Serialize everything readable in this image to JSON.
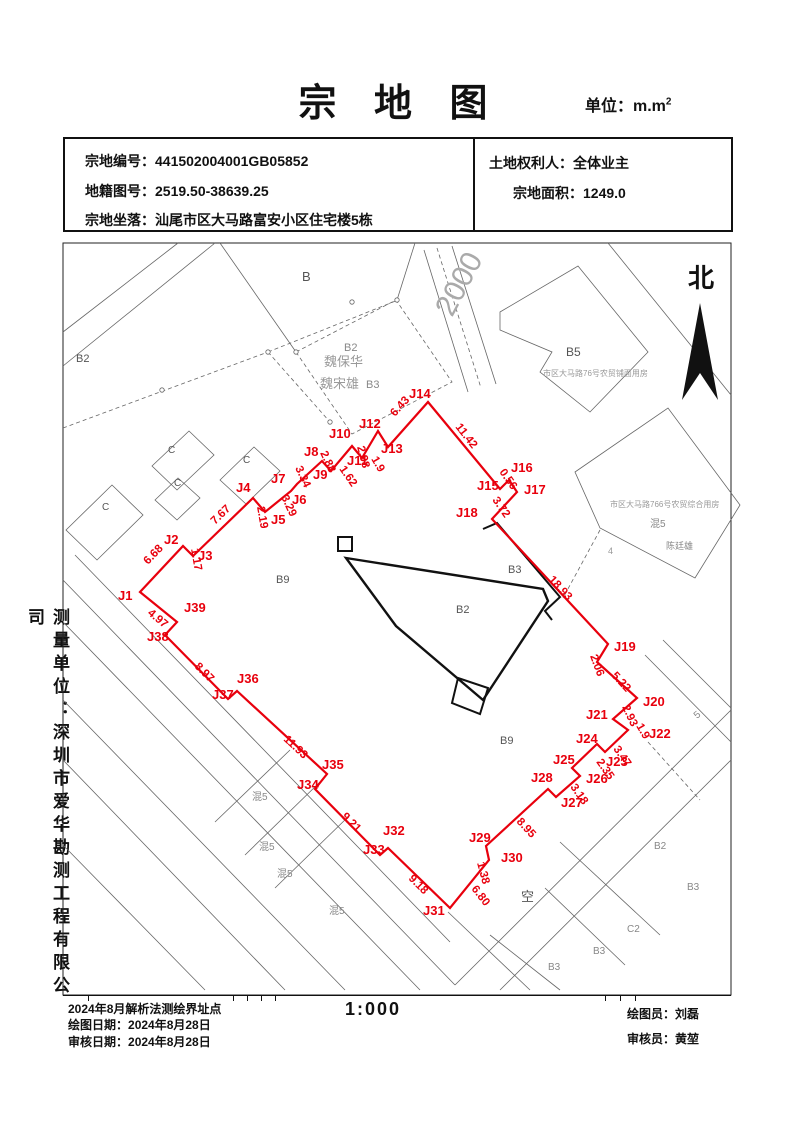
{
  "title": {
    "text": "宗 地 图",
    "unit_prefix": "单位：m.m",
    "unit_sup": "2"
  },
  "info_box": {
    "rows": [
      {
        "label": "宗地编号：",
        "value": "441502004001GB05852"
      },
      {
        "label": "地籍图号：",
        "value": "2519.50-38639.25"
      },
      {
        "label": "宗地坐落：",
        "value": "汕尾市区大马路富安小区住宅楼5栋"
      }
    ],
    "owner_label": "土地权利人：",
    "owner": "全体业主",
    "area_label": "宗地面积：",
    "area": "1249.0"
  },
  "north_label": "北",
  "sidebar_text": "测量单位：深圳市爱华勘测工程有限公司",
  "footer": {
    "method": "2024年8月解析法测绘界址点",
    "draw_label": "绘图日期：",
    "draw_date": "2024年8月28日",
    "check_label": "审核日期：",
    "check_date": "2024年8月28日",
    "scale": "1:000",
    "drafter_label": "绘图员：",
    "drafter": "刘磊",
    "checker_label": "审核员：",
    "checker": "黄堃"
  },
  "map": {
    "accent_color": "#e8000d",
    "parcel": {
      "points": [
        {
          "n": "J1",
          "x": 140,
          "y": 592
        },
        {
          "n": "J2",
          "x": 183,
          "y": 546
        },
        {
          "n": "J3",
          "x": 193,
          "y": 556
        },
        {
          "n": "J4",
          "x": 253,
          "y": 498
        },
        {
          "n": "J5",
          "x": 265,
          "y": 512
        },
        {
          "n": "J6",
          "x": 291,
          "y": 491
        },
        {
          "n": "J7",
          "x": 297,
          "y": 484
        },
        {
          "n": "J8",
          "x": 322,
          "y": 461
        },
        {
          "n": "J9",
          "x": 331,
          "y": 471
        },
        {
          "n": "J10",
          "x": 352,
          "y": 446
        },
        {
          "n": "J11",
          "x": 362,
          "y": 458
        },
        {
          "n": "J12",
          "x": 378,
          "y": 431
        },
        {
          "n": "J13",
          "x": 388,
          "y": 447
        },
        {
          "n": "J14",
          "x": 428,
          "y": 402
        },
        {
          "n": "J15",
          "x": 500,
          "y": 489
        },
        {
          "n": "J16",
          "x": 509,
          "y": 480
        },
        {
          "n": "J17",
          "x": 517,
          "y": 492
        },
        {
          "n": "J18",
          "x": 492,
          "y": 519
        },
        {
          "n": "J19",
          "x": 608,
          "y": 644
        },
        {
          "n": "",
          "x": 597,
          "y": 662
        },
        {
          "n": "J20",
          "x": 637,
          "y": 698
        },
        {
          "n": "J21",
          "x": 613,
          "y": 719
        },
        {
          "n": "J22",
          "x": 628,
          "y": 730
        },
        {
          "n": "J23",
          "x": 605,
          "y": 752
        },
        {
          "n": "J24",
          "x": 597,
          "y": 744
        },
        {
          "n": "J25",
          "x": 572,
          "y": 768
        },
        {
          "n": "J26",
          "x": 580,
          "y": 776
        },
        {
          "n": "J27",
          "x": 556,
          "y": 797
        },
        {
          "n": "J28",
          "x": 548,
          "y": 789
        },
        {
          "n": "J29",
          "x": 486,
          "y": 846
        },
        {
          "n": "J30",
          "x": 489,
          "y": 860
        },
        {
          "n": "J31",
          "x": 450,
          "y": 908
        },
        {
          "n": "J32",
          "x": 388,
          "y": 848
        },
        {
          "n": "J33",
          "x": 380,
          "y": 855
        },
        {
          "n": "J34",
          "x": 315,
          "y": 789
        },
        {
          "n": "J35",
          "x": 327,
          "y": 774
        },
        {
          "n": "J36",
          "x": 237,
          "y": 691
        },
        {
          "n": "J37",
          "x": 228,
          "y": 699
        },
        {
          "n": "J38",
          "x": 165,
          "y": 635
        },
        {
          "n": "J39",
          "x": 177,
          "y": 622
        }
      ]
    },
    "point_labels": [
      {
        "t": "J1",
        "x": 118,
        "y": 600
      },
      {
        "t": "J2",
        "x": 164,
        "y": 544
      },
      {
        "t": "J3",
        "x": 198,
        "y": 560
      },
      {
        "t": "J4",
        "x": 236,
        "y": 492
      },
      {
        "t": "J5",
        "x": 271,
        "y": 524
      },
      {
        "t": "J6",
        "x": 292,
        "y": 504
      },
      {
        "t": "J7",
        "x": 271,
        "y": 483
      },
      {
        "t": "J8",
        "x": 304,
        "y": 456
      },
      {
        "t": "J9",
        "x": 313,
        "y": 479
      },
      {
        "t": "J10",
        "x": 329,
        "y": 438
      },
      {
        "t": "J11",
        "x": 347,
        "y": 465
      },
      {
        "t": "J12",
        "x": 359,
        "y": 428
      },
      {
        "t": "J13",
        "x": 381,
        "y": 453
      },
      {
        "t": "J14",
        "x": 409,
        "y": 398
      },
      {
        "t": "J15",
        "x": 477,
        "y": 490
      },
      {
        "t": "J16",
        "x": 511,
        "y": 472
      },
      {
        "t": "J17",
        "x": 524,
        "y": 494
      },
      {
        "t": "J18",
        "x": 456,
        "y": 517
      },
      {
        "t": "J19",
        "x": 614,
        "y": 651
      },
      {
        "t": "J20",
        "x": 643,
        "y": 706
      },
      {
        "t": "J21",
        "x": 586,
        "y": 719
      },
      {
        "t": "J22",
        "x": 649,
        "y": 738
      },
      {
        "t": "J23",
        "x": 606,
        "y": 766
      },
      {
        "t": "J24",
        "x": 576,
        "y": 743
      },
      {
        "t": "J25",
        "x": 553,
        "y": 764
      },
      {
        "t": "J26",
        "x": 586,
        "y": 783
      },
      {
        "t": "J27",
        "x": 561,
        "y": 807
      },
      {
        "t": "J28",
        "x": 531,
        "y": 782
      },
      {
        "t": "J29",
        "x": 469,
        "y": 842
      },
      {
        "t": "J30",
        "x": 501,
        "y": 862
      },
      {
        "t": "J31",
        "x": 423,
        "y": 915
      },
      {
        "t": "J32",
        "x": 383,
        "y": 835
      },
      {
        "t": "J33",
        "x": 363,
        "y": 854
      },
      {
        "t": "J34",
        "x": 297,
        "y": 789
      },
      {
        "t": "J35",
        "x": 322,
        "y": 769
      },
      {
        "t": "J36",
        "x": 237,
        "y": 683
      },
      {
        "t": "J37",
        "x": 212,
        "y": 699
      },
      {
        "t": "J38",
        "x": 147,
        "y": 641
      },
      {
        "t": "J39",
        "x": 184,
        "y": 612
      }
    ],
    "distance_labels": [
      {
        "t": "6.68",
        "x": 148,
        "y": 565,
        "r": -46
      },
      {
        "t": "1.17",
        "x": 191,
        "y": 549,
        "r": 80
      },
      {
        "t": "7.67",
        "x": 215,
        "y": 525,
        "r": -44
      },
      {
        "t": "2.19",
        "x": 257,
        "y": 507,
        "r": 80
      },
      {
        "t": "3.29",
        "x": 281,
        "y": 497,
        "r": 65
      },
      {
        "t": "3.34",
        "x": 295,
        "y": 468,
        "r": 65
      },
      {
        "t": "2.88",
        "x": 320,
        "y": 453,
        "r": 65
      },
      {
        "t": "2.98",
        "x": 357,
        "y": 447,
        "r": 75
      },
      {
        "t": "1.62",
        "x": 339,
        "y": 469,
        "r": 55
      },
      {
        "t": "1.9",
        "x": 371,
        "y": 459,
        "r": 60
      },
      {
        "t": "6.43",
        "x": 395,
        "y": 417,
        "r": -48
      },
      {
        "t": "11.42",
        "x": 455,
        "y": 427,
        "r": 52
      },
      {
        "t": "0.56",
        "x": 499,
        "y": 472,
        "r": 55
      },
      {
        "t": "3.72",
        "x": 492,
        "y": 500,
        "r": 55
      },
      {
        "t": "18.93",
        "x": 548,
        "y": 580,
        "r": 47
      },
      {
        "t": "2.06",
        "x": 590,
        "y": 656,
        "r": 70
      },
      {
        "t": "5.22",
        "x": 611,
        "y": 676,
        "r": 47
      },
      {
        "t": "2.93",
        "x": 622,
        "y": 707,
        "r": 65
      },
      {
        "t": "1.9",
        "x": 636,
        "y": 726,
        "r": 60
      },
      {
        "t": "3.47",
        "x": 613,
        "y": 749,
        "r": 55
      },
      {
        "t": "2.35",
        "x": 596,
        "y": 762,
        "r": 55
      },
      {
        "t": "3.18",
        "x": 570,
        "y": 787,
        "r": 55
      },
      {
        "t": "8.95",
        "x": 516,
        "y": 822,
        "r": 47
      },
      {
        "t": "1.38",
        "x": 477,
        "y": 863,
        "r": 75
      },
      {
        "t": "6.80",
        "x": 471,
        "y": 889,
        "r": 52
      },
      {
        "t": "9.18",
        "x": 408,
        "y": 879,
        "r": 45
      },
      {
        "t": "9.21",
        "x": 341,
        "y": 817,
        "r": 45
      },
      {
        "t": "11.93",
        "x": 283,
        "y": 740,
        "r": 43
      },
      {
        "t": "8.97",
        "x": 194,
        "y": 667,
        "r": 45
      },
      {
        "t": "4.97",
        "x": 147,
        "y": 614,
        "r": 40
      }
    ],
    "bg_labels": [
      {
        "t": "B2",
        "x": 76,
        "y": 362,
        "s": 11,
        "c": "#555",
        "r": 0
      },
      {
        "t": "B",
        "x": 302,
        "y": 281,
        "s": 13,
        "c": "#555",
        "r": 0
      },
      {
        "t": "C",
        "x": 168,
        "y": 453,
        "s": 10,
        "c": "#555",
        "r": 0
      },
      {
        "t": "C",
        "x": 174,
        "y": 486,
        "s": 10,
        "c": "#555",
        "r": 0
      },
      {
        "t": "C",
        "x": 243,
        "y": 463,
        "s": 10,
        "c": "#555",
        "r": 0
      },
      {
        "t": "C",
        "x": 102,
        "y": 510,
        "s": 10,
        "c": "#555",
        "r": 0
      },
      {
        "t": "B2",
        "x": 344,
        "y": 351,
        "s": 11,
        "c": "#888",
        "r": 0
      },
      {
        "t": "魏保华",
        "x": 324,
        "y": 366,
        "s": 13,
        "c": "#999",
        "r": 0
      },
      {
        "t": "魏宋雄",
        "x": 320,
        "y": 388,
        "s": 13,
        "c": "#999",
        "r": 0
      },
      {
        "t": "B3",
        "x": 366,
        "y": 388,
        "s": 11,
        "c": "#888",
        "r": 0
      },
      {
        "t": "2000",
        "x": 452,
        "y": 318,
        "s": 30,
        "c": "#aaa",
        "r": -62
      },
      {
        "t": "B5",
        "x": 566,
        "y": 356,
        "s": 12,
        "c": "#555",
        "r": 0
      },
      {
        "t": "市区大马路76号农贸铺面用房",
        "x": 543,
        "y": 376,
        "s": 8,
        "c": "#999",
        "r": 0
      },
      {
        "t": "市区大马路766号农贸综合用房",
        "x": 610,
        "y": 507,
        "s": 8,
        "c": "#999",
        "r": 0
      },
      {
        "t": "混5",
        "x": 650,
        "y": 527,
        "s": 10,
        "c": "#888",
        "r": 0
      },
      {
        "t": "陈廷雄",
        "x": 666,
        "y": 549,
        "s": 9,
        "c": "#888",
        "r": 0
      },
      {
        "t": "B9",
        "x": 276,
        "y": 583,
        "s": 11,
        "c": "#555",
        "r": 0
      },
      {
        "t": "B3",
        "x": 508,
        "y": 573,
        "s": 11,
        "c": "#555",
        "r": 0
      },
      {
        "t": "B2",
        "x": 456,
        "y": 613,
        "s": 11,
        "c": "#555",
        "r": 0
      },
      {
        "t": "B9",
        "x": 500,
        "y": 744,
        "s": 11,
        "c": "#555",
        "r": 0
      },
      {
        "t": "混5",
        "x": 252,
        "y": 800,
        "s": 10,
        "c": "#888",
        "r": 0
      },
      {
        "t": "混5",
        "x": 259,
        "y": 850,
        "s": 10,
        "c": "#888",
        "r": 0
      },
      {
        "t": "混5",
        "x": 277,
        "y": 877,
        "s": 10,
        "c": "#888",
        "r": 0
      },
      {
        "t": "混5",
        "x": 329,
        "y": 914,
        "s": 10,
        "c": "#888",
        "r": 0
      },
      {
        "t": "空",
        "x": 521,
        "y": 901,
        "s": 13,
        "c": "#555",
        "r": 0
      },
      {
        "t": "B2",
        "x": 654,
        "y": 849,
        "s": 10,
        "c": "#888",
        "r": 0
      },
      {
        "t": "B3",
        "x": 687,
        "y": 890,
        "s": 10,
        "c": "#888",
        "r": 0
      },
      {
        "t": "C2",
        "x": 627,
        "y": 932,
        "s": 10,
        "c": "#888",
        "r": 0
      },
      {
        "t": "B3",
        "x": 593,
        "y": 954,
        "s": 10,
        "c": "#888",
        "r": 0
      },
      {
        "t": "B3",
        "x": 548,
        "y": 970,
        "s": 10,
        "c": "#888",
        "r": 0
      },
      {
        "t": "5",
        "x": 697,
        "y": 719,
        "s": 10,
        "c": "#888",
        "r": -40
      },
      {
        "t": "4",
        "x": 608,
        "y": 554,
        "s": 9,
        "c": "#999",
        "r": 0
      }
    ],
    "bg_lines": [
      [
        63,
        332,
        178,
        243,
        0
      ],
      [
        63,
        366,
        215,
        243,
        0
      ],
      [
        75,
        555,
        450,
        942,
        0
      ],
      [
        63,
        580,
        455,
        985,
        0
      ],
      [
        63,
        622,
        420,
        990,
        0
      ],
      [
        63,
        700,
        345,
        990,
        0
      ],
      [
        63,
        760,
        285,
        990,
        0
      ],
      [
        63,
        845,
        205,
        990,
        0
      ],
      [
        215,
        822,
        290,
        750,
        0
      ],
      [
        245,
        855,
        320,
        782,
        0
      ],
      [
        275,
        888,
        350,
        815,
        0
      ],
      [
        455,
        985,
        731,
        710,
        0
      ],
      [
        500,
        990,
        731,
        760,
        0
      ],
      [
        560,
        842,
        660,
        935,
        0
      ],
      [
        545,
        888,
        625,
        965,
        0
      ],
      [
        490,
        935,
        560,
        990,
        0
      ],
      [
        448,
        912,
        530,
        990,
        0
      ],
      [
        645,
        655,
        731,
        742,
        0
      ],
      [
        663,
        640,
        731,
        708,
        0
      ],
      [
        608,
        243,
        731,
        395,
        0
      ],
      [
        424,
        250,
        468,
        392,
        0
      ],
      [
        452,
        246,
        496,
        384,
        0
      ],
      [
        437,
        248,
        481,
        388,
        1
      ],
      [
        63,
        428,
        268,
        352,
        1
      ],
      [
        268,
        352,
        398,
        300,
        1
      ],
      [
        268,
        352,
        330,
        422,
        1
      ],
      [
        220,
        243,
        296,
        352,
        0
      ],
      [
        397,
        300,
        415,
        243,
        0
      ],
      [
        600,
        530,
        563,
        598,
        1
      ],
      [
        648,
        742,
        700,
        800,
        1
      ]
    ],
    "bg_polys": [
      {
        "pts": "152,466 189,431 214,455 177,490",
        "dash": 0
      },
      {
        "pts": "155,500 178,478 200,498 177,520",
        "dash": 0
      },
      {
        "pts": "220,480 254,447 280,471 246,504",
        "dash": 0
      },
      {
        "pts": "66,530 112,485 143,515 97,560",
        "dash": 0
      },
      {
        "pts": "296,352 396,300 452,382 352,434",
        "dash": 1
      },
      {
        "pts": "500,312 578,266 648,352 590,412 540,372 552,352 500,330",
        "dash": 0
      },
      {
        "pts": "575,472 668,408 740,505 695,578 600,528",
        "dash": 0
      }
    ],
    "node_circles": [
      [
        162,
        390
      ],
      [
        268,
        352
      ],
      [
        330,
        422
      ],
      [
        352,
        302
      ],
      [
        296,
        352
      ],
      [
        397,
        300
      ]
    ],
    "buildings": [
      {
        "pts": "338,537 352,537 352,551 338,551",
        "closed": 1,
        "w": 2
      },
      {
        "pts": "346,558 543,589 548,601 483,700 396,626",
        "closed": 1,
        "w": 2.4
      },
      {
        "pts": "458,678 488,688 480,714 452,703",
        "closed": 1,
        "w": 2
      },
      {
        "pts": "483,529 497,523 560,597 545,611 552,620",
        "closed": 0,
        "w": 2
      }
    ],
    "north_arrow": "700,303 682,400 700,373 718,400",
    "frame": {
      "x": 63,
      "y": 243,
      "w": 668,
      "h": 752
    }
  }
}
